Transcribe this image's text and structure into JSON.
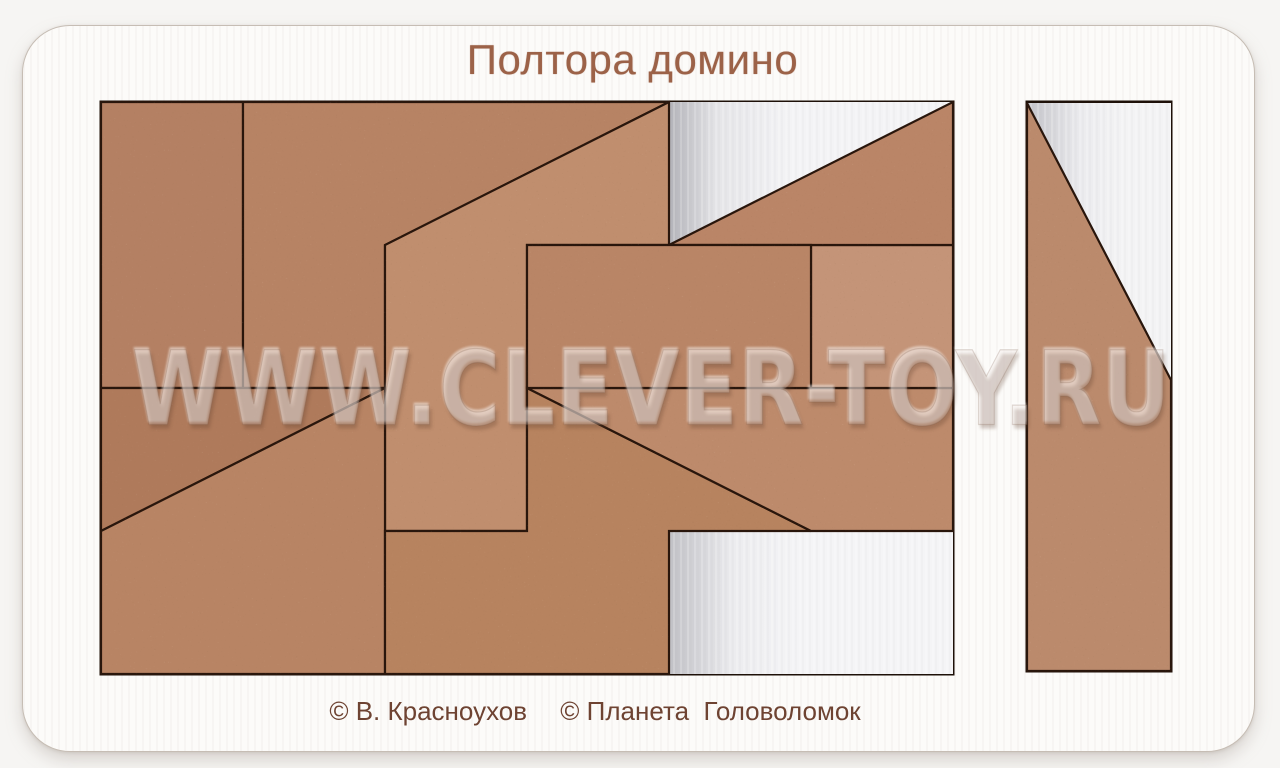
{
  "title": "Полтора домино",
  "credits": {
    "author": "© В. Красноухов",
    "publisher": "© Планета  Головоломок"
  },
  "watermark": "WWW.CLEVER-TOY.RU",
  "colors": {
    "background": "#f6f5f3",
    "board": "#fcfbf9",
    "board_edge": "#c6bdb4",
    "seam": "#29160c",
    "tray_wall": "#1d1008",
    "floor": "#e9eaec",
    "title_text": "#9c6248",
    "credit_text": "#6e4332",
    "mdf_base": "#b88465"
  },
  "board": {
    "x": 22,
    "y": 25,
    "width": 1231,
    "height": 725,
    "radius": 48
  },
  "trays": [
    {
      "name": "main-tray",
      "x": 101,
      "y": 102,
      "width": 852,
      "height": 572
    },
    {
      "name": "right-slot-tray",
      "x": 1027,
      "y": 102,
      "width": 144,
      "height": 569
    }
  ],
  "empty_slots": [
    {
      "name": "empty-triangle-top",
      "gradient": "grad-e1",
      "points": [
        [
          669,
          102
        ],
        [
          953,
          102
        ],
        [
          669,
          245
        ]
      ]
    },
    {
      "name": "empty-rect-bottom",
      "gradient": "grad-e2",
      "points": [
        [
          669,
          531
        ],
        [
          953,
          531
        ],
        [
          953,
          674
        ],
        [
          669,
          674
        ]
      ]
    },
    {
      "name": "empty-triangle-right-slot",
      "gradient": "grad-e3",
      "points": [
        [
          1027,
          103
        ],
        [
          1171,
          103
        ],
        [
          1171,
          380
        ]
      ]
    }
  ],
  "pieces": [
    {
      "name": "piece-domino-vertical-left",
      "fill": "#b48063",
      "points": [
        [
          101,
          102
        ],
        [
          243,
          102
        ],
        [
          243,
          388
        ],
        [
          101,
          388
        ]
      ]
    },
    {
      "name": "piece-arrow-top",
      "fill": "#b78364",
      "points": [
        [
          243,
          102
        ],
        [
          669,
          102
        ],
        [
          385,
          245
        ],
        [
          385,
          388
        ],
        [
          243,
          388
        ]
      ]
    },
    {
      "name": "piece-zigzag-center",
      "fill": "#c08e6e",
      "points": [
        [
          669,
          102
        ],
        [
          669,
          245
        ],
        [
          527,
          245
        ],
        [
          527,
          531
        ],
        [
          385,
          531
        ],
        [
          385,
          245
        ]
      ]
    },
    {
      "name": "piece-triangle-west",
      "fill": "#af7a5b",
      "points": [
        [
          101,
          388
        ],
        [
          385,
          388
        ],
        [
          101,
          531
        ]
      ]
    },
    {
      "name": "piece-quad-bottom-left",
      "fill": "#b88464",
      "points": [
        [
          385,
          388
        ],
        [
          385,
          674
        ],
        [
          101,
          674
        ],
        [
          101,
          531
        ]
      ]
    },
    {
      "name": "piece-step-bottom-center",
      "fill": "#b7835f",
      "points": [
        [
          527,
          388
        ],
        [
          811,
          531
        ],
        [
          669,
          531
        ],
        [
          669,
          674
        ],
        [
          385,
          674
        ],
        [
          385,
          531
        ],
        [
          527,
          531
        ]
      ]
    },
    {
      "name": "piece-trapezoid-bottom-right",
      "fill": "#bd8a6b",
      "points": [
        [
          527,
          388
        ],
        [
          953,
          388
        ],
        [
          953,
          531
        ],
        [
          811,
          531
        ]
      ]
    },
    {
      "name": "piece-square-east",
      "fill": "#c49478",
      "points": [
        [
          811,
          245
        ],
        [
          953,
          245
        ],
        [
          953,
          388
        ],
        [
          811,
          388
        ]
      ]
    },
    {
      "name": "piece-triangle-north-east",
      "fill": "#ba8567",
      "points": [
        [
          953,
          102
        ],
        [
          953,
          245
        ],
        [
          669,
          245
        ]
      ]
    },
    {
      "name": "piece-domino-horizontal",
      "fill": "#b98566",
      "points": [
        [
          527,
          245
        ],
        [
          811,
          245
        ],
        [
          811,
          388
        ],
        [
          527,
          388
        ]
      ]
    },
    {
      "name": "piece-right-slot-column",
      "fill": "#bb8a6c",
      "points": [
        [
          1027,
          103
        ],
        [
          1171,
          380
        ],
        [
          1171,
          671
        ],
        [
          1027,
          671
        ]
      ]
    }
  ]
}
